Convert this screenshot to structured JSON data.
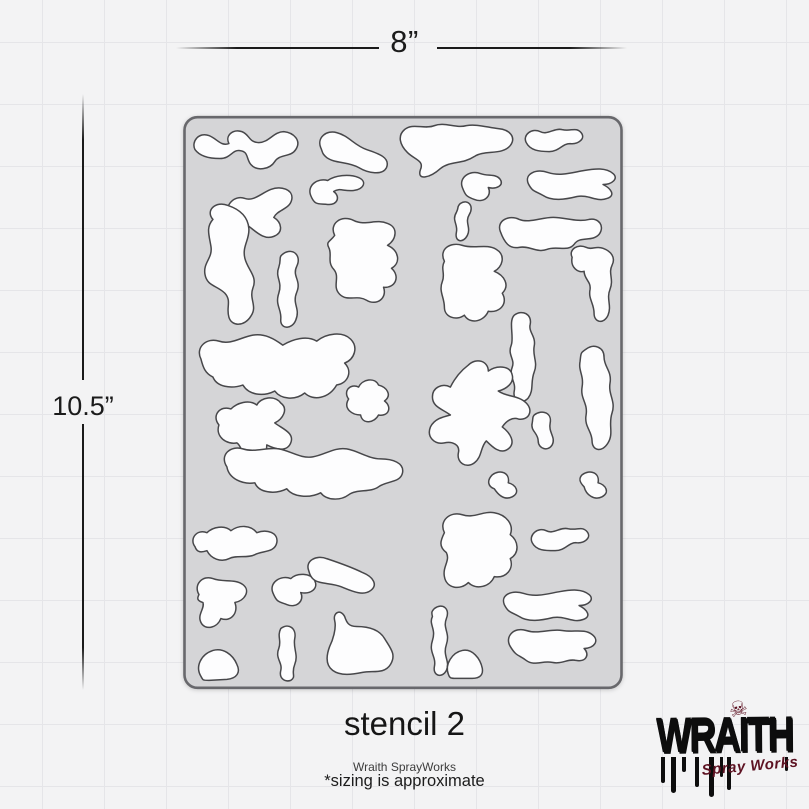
{
  "page": {
    "background_color": "#f3f3f4",
    "grid_color": "#e5e5e8"
  },
  "dimension_labels": {
    "width": "8”",
    "height": "10.5”"
  },
  "stencil": {
    "viewbox": "0 0 441 575",
    "sheet_fill": "#d5d5d7",
    "sheet_stroke": "#68686c",
    "shape_fill": "#fdfdfe",
    "shape_stroke": "#47474a",
    "shapes": [
      "M12,34 C8,26 16,16 26,20 C34,23 38,31 46,28 C42,20 50,13 59,16 C67,19 66,27 76,27 C86,27 91,16 101,16 C111,17 119,25 113,34 C108,42 97,38 92,46 C87,54 74,56 68,49 C63,43 66,36 57,35 C49,34 48,43 37,43 C26,43 17,41 12,34 Z",
      "M138,32 C134,22 144,14 154,17 C166,20 172,30 184,34 C196,38 208,42 204,52 C200,60 186,58 176,52 C166,46 152,48 144,42 C139,38 140,36 138,32 Z",
      "M222,14 C230,7 242,14 252,10 C262,6 274,13 284,10 C294,8 306,12 316,13 C328,14 334,22 328,30 C320,40 302,34 292,41 C280,49 268,45 258,53 C248,62 234,66 238,54 C242,45 232,44 225,37 C217,29 215,20 222,14 Z",
      "M344,27 C340,19 350,12 358,16 C365,20 372,12 380,14 C389,16 394,11 399,17 C404,23 396,29 388,28 C380,28 377,36 367,36 C357,36 348,35 344,27 Z",
      "M346,68 C342,58 354,53 366,57 C378,61 390,57 402,55 C413,53 424,52 431,58 C437,63 430,69 421,69 C429,73 434,80 425,83 C415,87 407,79 395,81 C383,84 370,86 361,80 C352,75 350,76 346,68 Z",
      "M280,72 C276,62 288,54 298,58 C306,61 314,58 318,64 C322,70 314,74 306,72 C310,80 302,88 292,84 C284,81 283,80 280,72 Z",
      "M46,102 C40,90 52,79 62,83 C71,86 78,78 88,74 C98,70 111,74 109,84 C107,94 95,94 91,102 C99,107 101,117 91,121 C81,125 73,116 66,111 C58,115 49,113 46,102 Z",
      "M128,80 C124,70 135,62 145,65 C152,60 166,58 176,62 C185,66 181,74 171,75 C161,76 157,72 151,76 C158,81 155,90 145,89 C135,88 132,90 128,80 Z",
      "M278,88 C286,83 292,91 287,99 C282,107 289,112 285,120 C281,128 272,127 274,117 C276,109 269,105 274,97 C277,91 274,92 278,88 Z",
      "M318,116 C314,105 327,99 337,104 C347,108 359,102 371,102 C383,102 395,107 407,104 C417,102 423,111 417,119 C410,127 398,120 392,129 C386,137 374,130 365,134 C355,138 347,130 337,132 C327,134 322,127 318,116 Z",
      "M30,104 C22,95 33,85 45,90 C57,94 65,101 66,113 C67,124 59,131 62,143 C65,155 75,161 70,173 C66,184 75,191 68,201 C62,211 49,212 46,202 C43,192 49,186 42,178 C34,170 24,171 22,159 C20,147 30,143 28,131 C26,119 23,112 30,104 Z",
      "M101,138 C111,132 119,141 114,151 C109,161 119,165 114,177 C109,189 118,193 113,205 C109,215 97,214 98,204 C99,194 92,190 96,178 C100,166 92,162 96,152 C99,143 95,142 101,138 Z",
      "M152,120 C146,108 159,99 171,105 C183,111 193,103 205,108 C216,112 214,124 205,130 C216,135 219,147 209,153 C218,161 213,173 201,172 C205,183 194,191 184,185 C174,179 165,187 157,179 C149,171 158,162 151,154 C144,146 150,139 146,132 C143,126 148,126 152,120 Z",
      "M262,146 C256,134 268,126 280,130 C292,134 304,128 314,134 C324,140 320,152 312,156 C322,160 328,170 320,178 C326,188 318,198 306,196 C302,206 288,210 282,200 C274,206 262,202 262,192 C262,182 256,176 260,166 C263,158 258,154 262,146 Z",
      "M390,142 C386,134 396,128 404,132 C410,135 414,130 421,133 C429,136 434,142 430,150 C426,158 432,164 428,174 C424,184 430,190 426,200 C422,209 412,208 412,198 C412,188 406,184 408,174 C409,166 402,164 402,156 C396,158 388,152 390,142 Z",
      "M404,234 C412,228 422,232 422,242 C422,252 430,256 428,268 C426,280 434,286 430,298 C426,310 432,318 426,328 C420,338 410,336 410,326 C410,316 402,312 404,300 C406,288 398,284 400,272 C402,260 396,256 398,246 C399,238 398,238 404,234 Z",
      "M18,244 C12,232 24,222 36,226 C48,230 58,222 70,220 C82,218 92,224 100,230 C110,224 124,220 134,226 C144,218 160,216 168,224 C176,232 172,244 162,248 C170,256 166,268 154,270 C146,284 130,286 122,278 C112,286 98,284 92,276 C80,282 66,280 60,270 C48,274 34,272 30,262 C22,258 20,252 18,244 Z",
      "M332,200 C340,194 350,199 348,209 C346,217 354,221 352,231 C350,241 356,247 352,257 C348,267 352,275 346,283 C340,290 330,286 332,276 C334,266 326,262 330,252 C333,244 325,240 329,230 C332,222 326,206 332,200 Z",
      "M36,310 C28,300 38,290 48,294 C54,288 66,284 74,290 C78,282 92,280 98,288 C106,294 100,304 92,308 C100,314 112,318 108,328 C104,338 92,334 84,330 C84,340 78,350 68,346 C58,342 60,332 54,328 C44,330 32,322 36,310 Z",
      "M166,284 C160,276 168,268 176,272 C180,264 192,262 196,270 C204,272 210,280 202,286 C210,292 206,302 196,300 C192,308 180,310 178,300 C170,300 160,294 166,284 Z",
      "M286,250 C294,242 306,246 306,256 C314,250 328,250 330,260 C332,268 324,274 316,276 C324,282 336,280 344,288 C352,296 346,306 336,304 C330,302 324,306 320,312 C328,318 334,328 326,334 C318,340 310,332 304,326 C298,332 300,342 292,348 C284,354 274,348 276,338 C278,330 270,326 262,328 C252,330 244,322 248,312 C252,304 260,302 268,300 C260,294 250,292 250,282 C250,272 260,268 268,272 C272,264 278,256 286,250 Z",
      "M352,300 C360,294 370,298 368,308 C366,318 374,322 370,330 C366,337 356,334 356,326 C356,318 348,316 350,308 C351,303 350,302 352,300 Z",
      "M310,360 C318,354 328,358 326,368 C334,370 338,378 330,382 C322,386 316,380 312,374 C306,372 304,366 310,360 Z",
      "M44,352 C36,340 48,330 60,334 C72,338 84,332 96,334 C108,336 118,344 130,342 C142,340 152,332 164,334 C176,336 186,344 198,344 C210,344 222,348 220,358 C218,368 204,366 196,372 C188,378 174,374 166,380 C158,386 144,386 138,378 C126,384 110,382 104,374 C92,380 76,378 72,368 C60,370 46,364 44,352 Z",
      "M400,360 C408,354 418,358 416,368 C424,370 428,378 420,382 C412,386 404,380 402,372 C398,368 396,364 400,360 Z",
      "M12,432 C6,424 14,414 24,418 C30,412 42,410 48,416 C56,410 68,410 74,418 C84,414 96,418 94,428 C92,438 80,436 72,440 C64,444 54,440 46,444 C38,448 28,444 24,436 C18,438 14,438 12,432 Z",
      "M16,480 C10,470 20,460 30,464 C40,468 52,464 60,470 C68,476 62,486 52,488 C56,498 48,508 38,504 C34,514 22,516 18,508 C14,500 22,494 20,488 C14,486 14,484 16,480 Z",
      "M90,478 C86,468 98,460 108,464 C114,458 128,458 132,466 C136,474 128,480 118,478 C122,486 114,494 104,490 C96,487 94,488 90,478 Z",
      "M126,456 C122,446 134,440 144,444 C156,448 168,452 180,458 C190,462 196,470 188,476 C180,482 168,476 158,472 C148,468 136,470 130,464 C127,461 127,459 126,456 Z",
      "M262,418 C256,406 268,396 280,400 C292,404 300,396 312,398 C324,400 332,410 328,420 C336,426 338,438 328,444 C332,454 324,464 312,462 C308,472 294,476 286,468 C278,476 264,474 262,462 C260,452 268,446 264,438 C256,432 258,426 262,418 Z",
      "M350,428 C346,420 356,412 364,416 C371,420 378,412 386,414 C395,416 400,411 405,417 C410,423 402,429 394,428 C386,428 383,436 373,436 C363,436 354,436 350,428 Z",
      "M322,490 C318,480 330,475 342,479 C354,483 366,479 378,477 C389,475 400,474 407,480 C413,485 406,491 397,491 C405,495 410,502 401,505 C391,509 383,501 371,503 C359,506 346,508 337,502 C328,497 326,498 322,490 Z",
      "M328,532 C322,522 332,512 344,516 C356,520 368,514 380,516 C392,518 402,514 410,520 C418,526 412,534 402,534 C408,540 404,548 394,546 C386,544 380,550 370,548 C360,546 352,552 344,546 C336,540 334,542 328,532 Z",
      "M252,494 C260,488 268,494 264,504 C260,514 268,518 264,530 C260,542 268,546 264,556 C260,564 250,562 252,552 C254,542 246,538 250,526 C254,514 246,510 250,502 C249,498 249,497 252,494 Z",
      "M266,560 C262,550 270,538 280,536 C290,534 298,544 300,554 C301,560 298,564 290,564 L272,564 C268,564 267,563 266,560 Z",
      "M18,562 C12,552 18,540 30,536 C40,533 50,540 54,550 C58,558 54,564 44,565 L26,566 C20,566 20,566 18,562 Z",
      "M98,514 C106,508 114,514 112,524 C110,534 116,540 112,550 C108,560 114,562 108,566 C102,568 96,564 98,556 C100,548 92,544 96,534 C99,526 94,522 98,514 Z",
      "M152,506 C150,498 158,494 162,502 C164,508 166,512 174,512 C184,512 196,514 202,524 C208,534 214,540 208,550 C202,560 190,556 180,558 C170,560 158,562 150,556 C142,550 144,540 147,532 C150,526 154,514 152,506 Z"
    ]
  },
  "caption": {
    "title": "stencil 2",
    "brand": "Wraith SprayWorks",
    "note": "*sizing is approximate"
  },
  "logo": {
    "wordmark": "WRAITH",
    "subtitle": "Spray Works",
    "skull_icon": "☠",
    "ink_color": "#0d0d0d",
    "accent_color": "#5d1222"
  }
}
